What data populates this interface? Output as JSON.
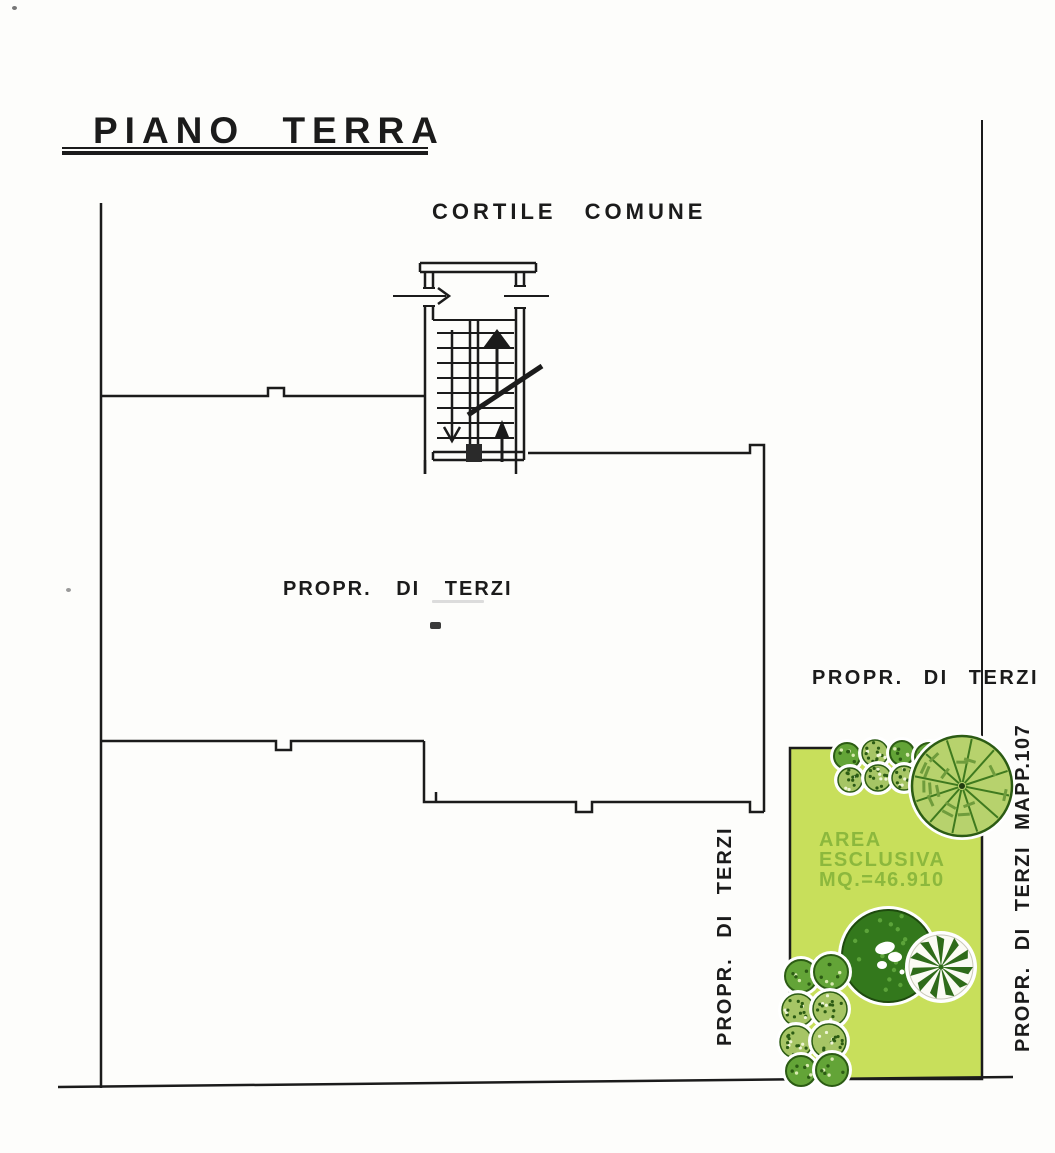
{
  "title": "PIANO TERRA",
  "labels": {
    "courtyard": "CORTILE COMUNE",
    "third_party_main": "PROPR. DI TERZI",
    "third_party_right": "PROPR. DI TERZI",
    "third_party_left_vertical": "PROPR. DI TERZI",
    "third_party_map_vertical": "PROPR. DI TERZI MAPP.107",
    "exclusive_area": {
      "line1": "AREA",
      "line2": "ESCLUSIVA",
      "line3": "MQ.=46.910"
    }
  },
  "colors": {
    "line": "#1b1b1b",
    "garden_fill": "#c8df5b",
    "garden_text": "#8cb83d",
    "halo": "#ffffff",
    "bush_solid": "#63a437",
    "bush_textured": "#a6c565",
    "bush_outline": "#2c5c14",
    "tree_dark": "#33781c",
    "tree_dark_speck": "#5ca33a",
    "tree_hatch_fill": "#b7d26d",
    "tree_hatch_line": "#3f7a1f",
    "star_dark": "#2f6b1a",
    "star_bg": "#fbfbf4"
  },
  "garden": {
    "trees": [
      {
        "type": "bush-solid",
        "cx": 847,
        "cy": 756,
        "r": 13
      },
      {
        "type": "bush-textured",
        "cx": 875,
        "cy": 753,
        "r": 13
      },
      {
        "type": "bush-solid",
        "cx": 902,
        "cy": 753,
        "r": 12
      },
      {
        "type": "bush-solid",
        "cx": 929,
        "cy": 757,
        "r": 14
      },
      {
        "type": "bush-textured",
        "cx": 850,
        "cy": 780,
        "r": 12
      },
      {
        "type": "bush-textured",
        "cx": 878,
        "cy": 778,
        "r": 13
      },
      {
        "type": "bush-textured",
        "cx": 904,
        "cy": 778,
        "r": 12
      },
      {
        "type": "bush-solid",
        "cx": 929,
        "cy": 783,
        "r": 13
      },
      {
        "type": "tree-hatched",
        "cx": 962,
        "cy": 786,
        "r": 50
      },
      {
        "type": "tree-dark",
        "cx": 888,
        "cy": 956,
        "r": 46
      },
      {
        "type": "tree-starburst",
        "cx": 941,
        "cy": 967,
        "r": 32
      },
      {
        "type": "bush-solid",
        "cx": 801,
        "cy": 976,
        "r": 16
      },
      {
        "type": "bush-solid",
        "cx": 831,
        "cy": 972,
        "r": 17
      },
      {
        "type": "bush-textured",
        "cx": 798,
        "cy": 1010,
        "r": 16
      },
      {
        "type": "bush-textured",
        "cx": 830,
        "cy": 1009,
        "r": 17
      },
      {
        "type": "bush-textured",
        "cx": 796,
        "cy": 1042,
        "r": 16
      },
      {
        "type": "bush-textured",
        "cx": 829,
        "cy": 1041,
        "r": 17
      },
      {
        "type": "bush-solid",
        "cx": 801,
        "cy": 1071,
        "r": 15
      },
      {
        "type": "bush-solid",
        "cx": 832,
        "cy": 1070,
        "r": 16
      }
    ]
  }
}
